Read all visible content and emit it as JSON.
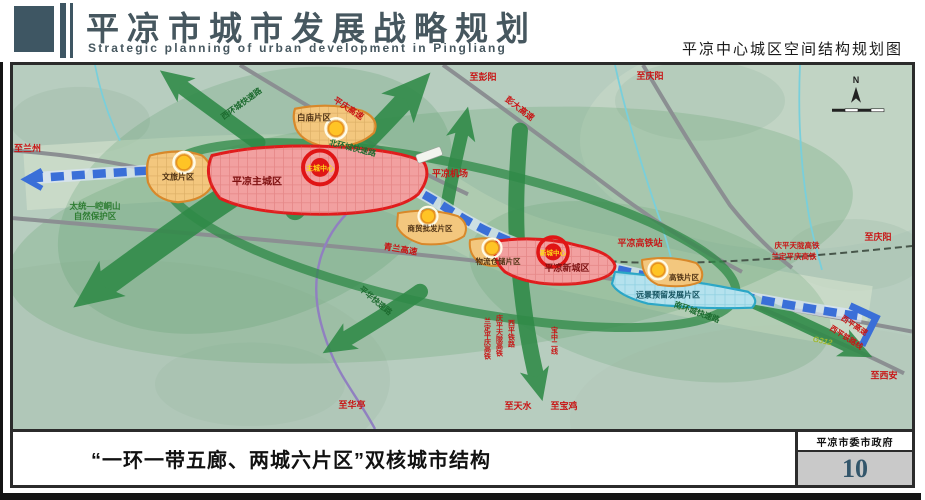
{
  "header": {
    "title_cn": "平凉市城市发展战略规划",
    "title_en": "Strategic planning of urban development in Pingliang",
    "map_title": "平凉中心城区空间结构规划图"
  },
  "footer": {
    "caption": "“一环一带五廊、两城六片区”双核城市结构",
    "organization": "平凉市委市政府",
    "page_number": "10"
  },
  "map": {
    "compass_label": "N",
    "zones": {
      "main_city": "平凉主城区",
      "main_city_center": "主城中心",
      "new_city": "平凉新城区",
      "new_city_center": "新城中心",
      "wenlv": "文旅片区",
      "baimiao": "白庙片区",
      "shangmao": "商贸批发片区",
      "wuliu": "物流仓储片区",
      "gaotie": "高铁片区",
      "yuanjing": "远景预留发展片区"
    },
    "landmarks": {
      "airport": "平凉机场",
      "hsr_station": "平凉高铁站",
      "nature_reserve_line1": "太统—崆峒山",
      "nature_reserve_line2": "自然保护区"
    },
    "roads": {
      "pingqing_expwy": "平庆高速",
      "pengda_expwy": "彭大高速",
      "qinglan_expwy": "青兰高速",
      "g312": "G312",
      "xiping_expwy": "西平高速",
      "xiping_railway": "西平铁路线"
    },
    "corridors": {
      "west_ring": "西环城快速路",
      "north_ring": "北环城快速路",
      "south_ring": "南环城快速路",
      "pinghua": "平华快速路"
    },
    "railways": {
      "qptl_hsr": "庆平天陇高铁",
      "ldpq_hsr": "兰定平庆高铁",
      "xiping_rail": "西平铁路",
      "baozhong_line": "宝中二线"
    },
    "destinations": {
      "lanzhou": "至兰州",
      "pengyang": "至彭阳",
      "qingyang_n": "至庆阳",
      "qingyang_e": "至庆阳",
      "xian": "至西安",
      "huating": "至华亭",
      "tianshui": "至天水",
      "baoji": "至宝鸡"
    },
    "colors": {
      "header_accent": "#3e5663",
      "terrain_green": "#b7cdbf",
      "corridor_green": "#2f8a47",
      "axis_blue": "#3a6fd8",
      "city_zone_red": "#e01c1c",
      "district_orange": "#e0962f",
      "reserved_cyan": "#2aa6c6",
      "road_label_red": "#c81414",
      "page_number_blue": "#33566b"
    }
  }
}
